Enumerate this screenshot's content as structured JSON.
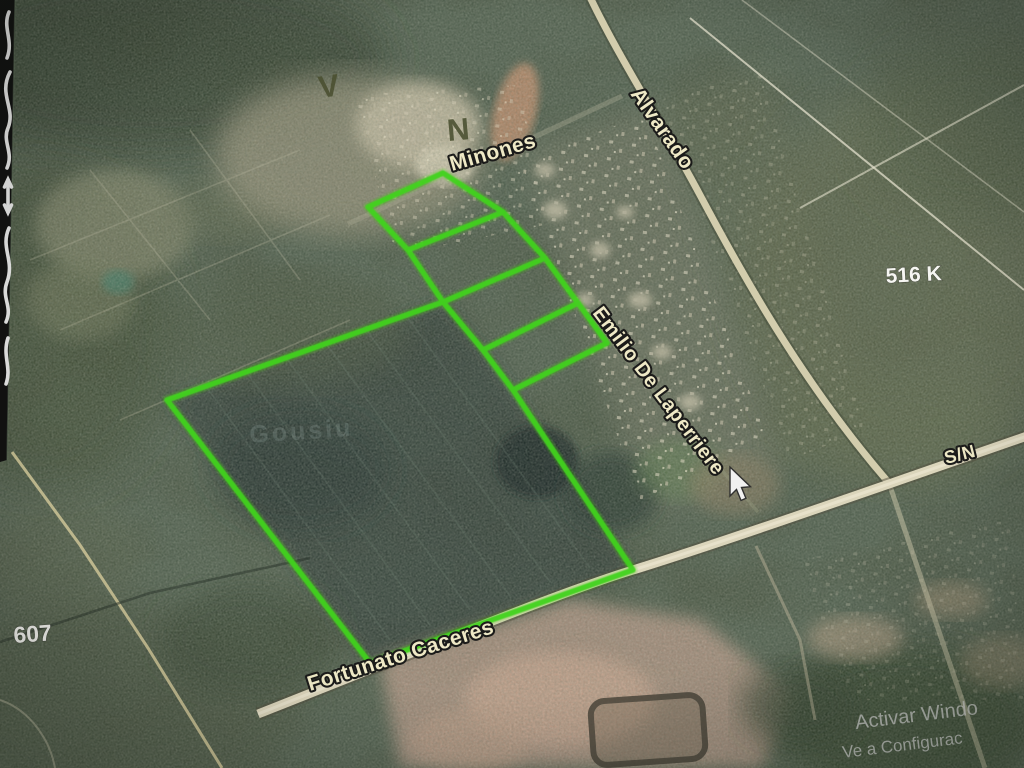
{
  "image": {
    "kind": "satellite-map-photo",
    "width": 1024,
    "height": 768
  },
  "labels": {
    "streets": {
      "minones": "Minones",
      "alvarado": "Alvarado",
      "emilio": "Emilio De Laperriere",
      "fortunato": "Fortunato Caceres",
      "sn": "S/N"
    },
    "parcels": {
      "k516": "516 K",
      "n607": "607"
    },
    "letters": {
      "v": "V",
      "n": "N"
    },
    "faint": "Gousiu"
  },
  "watermark": {
    "line1": "Activar Windo",
    "line2": "Ve a Configurac"
  },
  "colors": {
    "parcel_outline": "#3dd414",
    "street_label_fill": "#f3edc9",
    "street_label_stroke": "#141414",
    "white_label": "#fafaf7",
    "letter_fill": "#454b2b",
    "watermark_fill": "#dcdcdc",
    "road_fill": "#d9d2b6"
  }
}
